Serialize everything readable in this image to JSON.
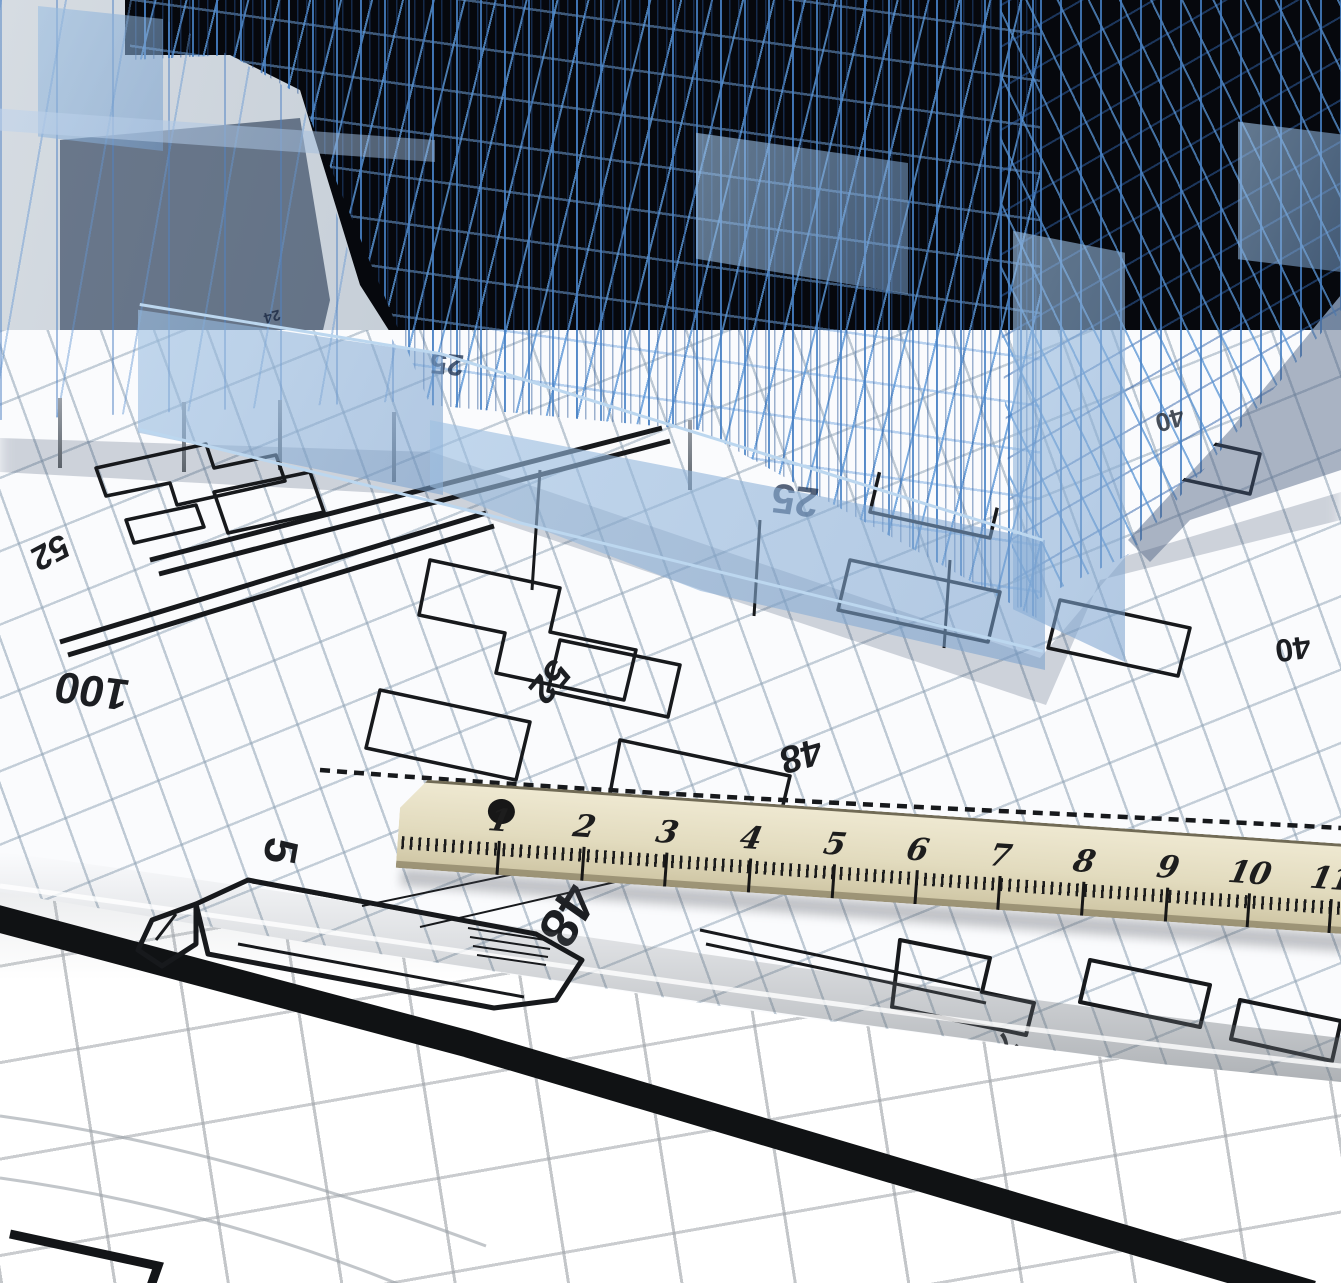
{
  "meta": {
    "type": "3d-architectural-render",
    "description": "Translucent blue 3D wireframe office building model standing on rolled architectural blueprint sheets, with a beige wooden ruler lying diagonally across the floor plans"
  },
  "building": {
    "wire_color": "#4a86c8",
    "glass_color": "#9fc0e2",
    "void_color": "#06080d"
  },
  "blueprint": {
    "paper_color": "#fafbfd",
    "grid_color": "#8ca0b2",
    "line_color": "#17191c",
    "annotations": [
      "52",
      "100",
      "25",
      "24",
      "25",
      "52",
      "48",
      "40",
      "40",
      "5",
      "48",
      "7"
    ]
  },
  "ruler": {
    "material_color": "#e0d9bc",
    "tick_color": "#1b1b1b",
    "has_end_dot": true,
    "marks": [
      "1",
      "2",
      "3",
      "4",
      "5",
      "6",
      "7",
      "8",
      "9",
      "10",
      "11"
    ]
  }
}
